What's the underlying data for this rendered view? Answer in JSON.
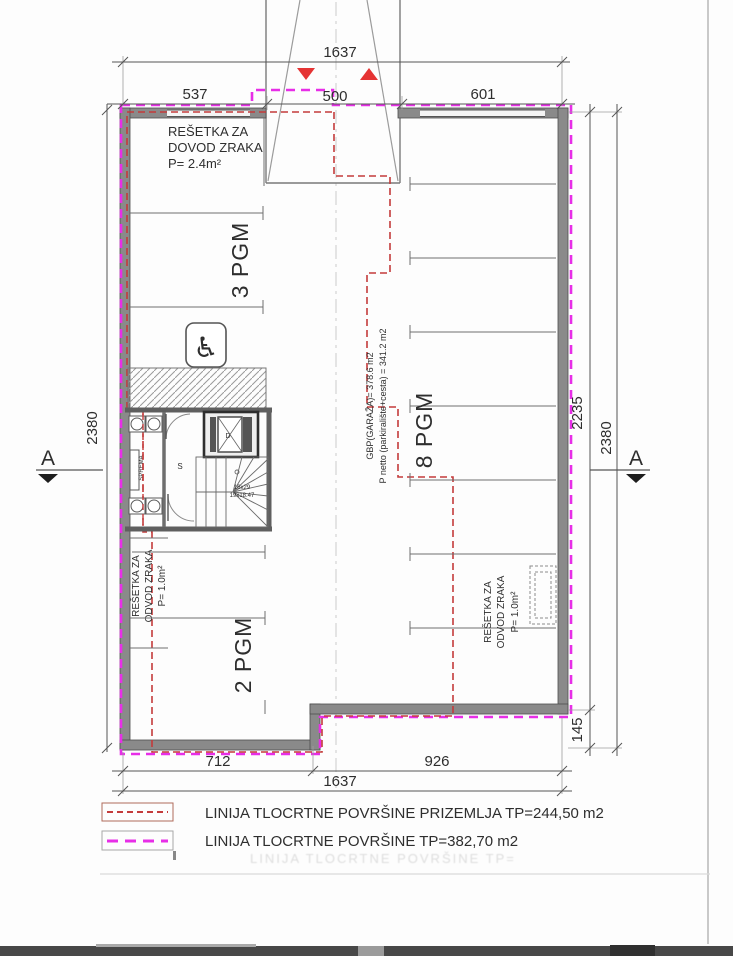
{
  "drawing": {
    "type": "architectural-floor-plan",
    "level": "garage"
  },
  "colors": {
    "outline_ground_floor": "#c43b3b",
    "outline_floor_area": "#e72ee7",
    "wall": "#8a8a8a",
    "ramp_arrow": "#e53333",
    "dim_line": "#555555"
  },
  "dims": {
    "top_overall": "1637",
    "seg_left": "537",
    "seg_center": "500",
    "seg_right": "601",
    "left_outer": "2380",
    "right_inner": "2235",
    "right_outer": "2380",
    "bottom_left": "712",
    "bottom_right": "926",
    "bottom_overall": "1637",
    "step": "145"
  },
  "rooms": {
    "parking_left": "3 PGM",
    "parking_right": "8 PGM",
    "parking_bottom": "2 PGM",
    "stair_hall": "S",
    "elevator": "D",
    "storage": "SPREMA",
    "stairs_l1": "16x29",
    "stairs_l2": "19x18.47"
  },
  "ann": {
    "top": [
      "REŠETKA ZA",
      "DOVOD ZRAKA",
      "P= 2.4m²"
    ],
    "left": [
      "REŠETKA ZA",
      "ODVOD ZRAKA",
      "P= 1.0m²"
    ],
    "right": [
      "REŠETKA ZA",
      "ODVOD ZRAKA",
      "P= 1.0m²"
    ],
    "gbp": [
      "GBP(GARAŽA)= 378.6 m2",
      "P netto (parkiralište+cesta) = 341.2 m2"
    ]
  },
  "markers": {
    "section": "A"
  },
  "icons": {
    "accessible_parking": "♿"
  },
  "legend": {
    "items": [
      {
        "style": "red-dashed",
        "color": "#c43b3b",
        "label": "LINIJA TLOCRTNE POVRŠINE PRIZEMLJA  TP=244,50 m2"
      },
      {
        "style": "magenta-dashed",
        "color": "#e72ee7",
        "label": "LINIJA TLOCRTNE POVRŠINE  TP=382,70 m2"
      }
    ]
  },
  "artifacts": {
    "ghost": "LINIJA TLOCRTNE POVRŠINE TP="
  }
}
